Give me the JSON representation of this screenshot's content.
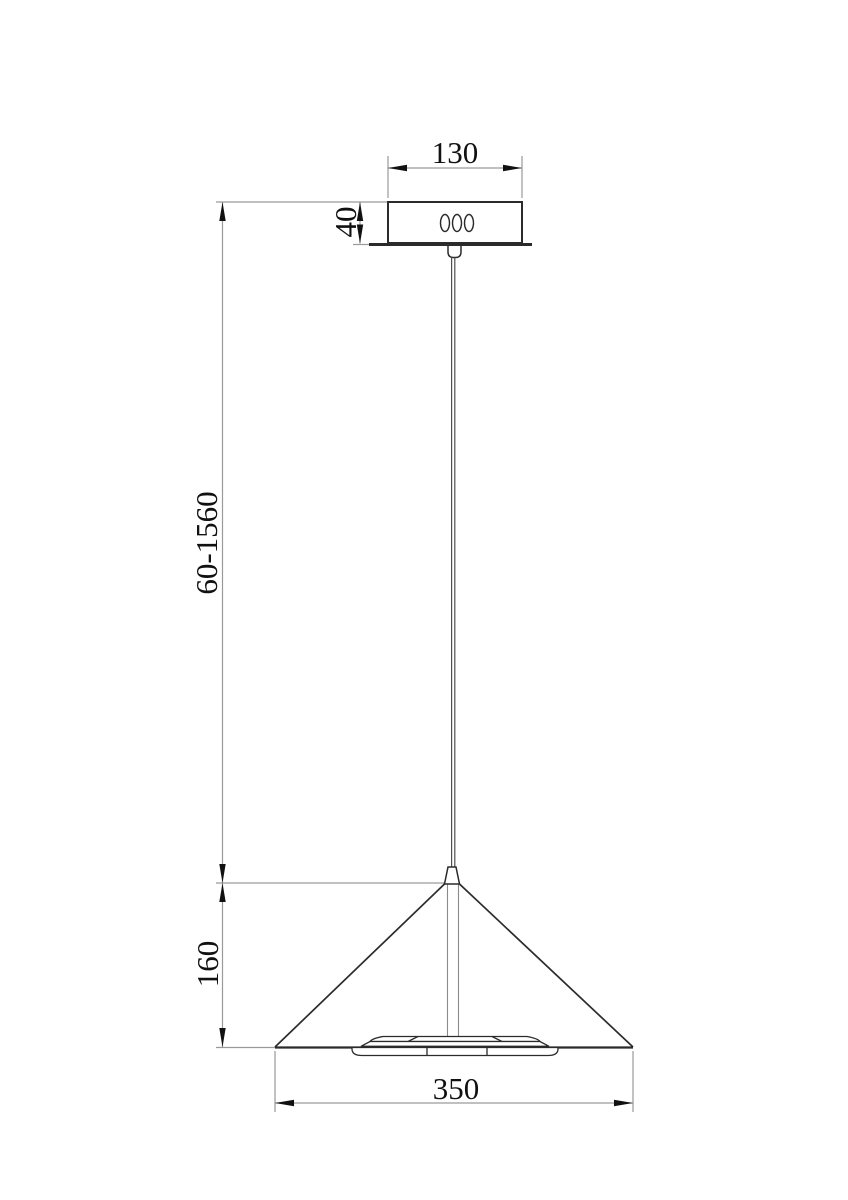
{
  "drawing": {
    "labels": {
      "canopy_width": "130",
      "canopy_height": "40",
      "suspension_length_range": "60-1560",
      "shade_height": "160",
      "shade_diameter": "350"
    },
    "colors": {
      "object_line": "#2b2b2b",
      "dimension_line": "#9a9a9a",
      "text": "#111111",
      "background": "#ffffff"
    }
  }
}
